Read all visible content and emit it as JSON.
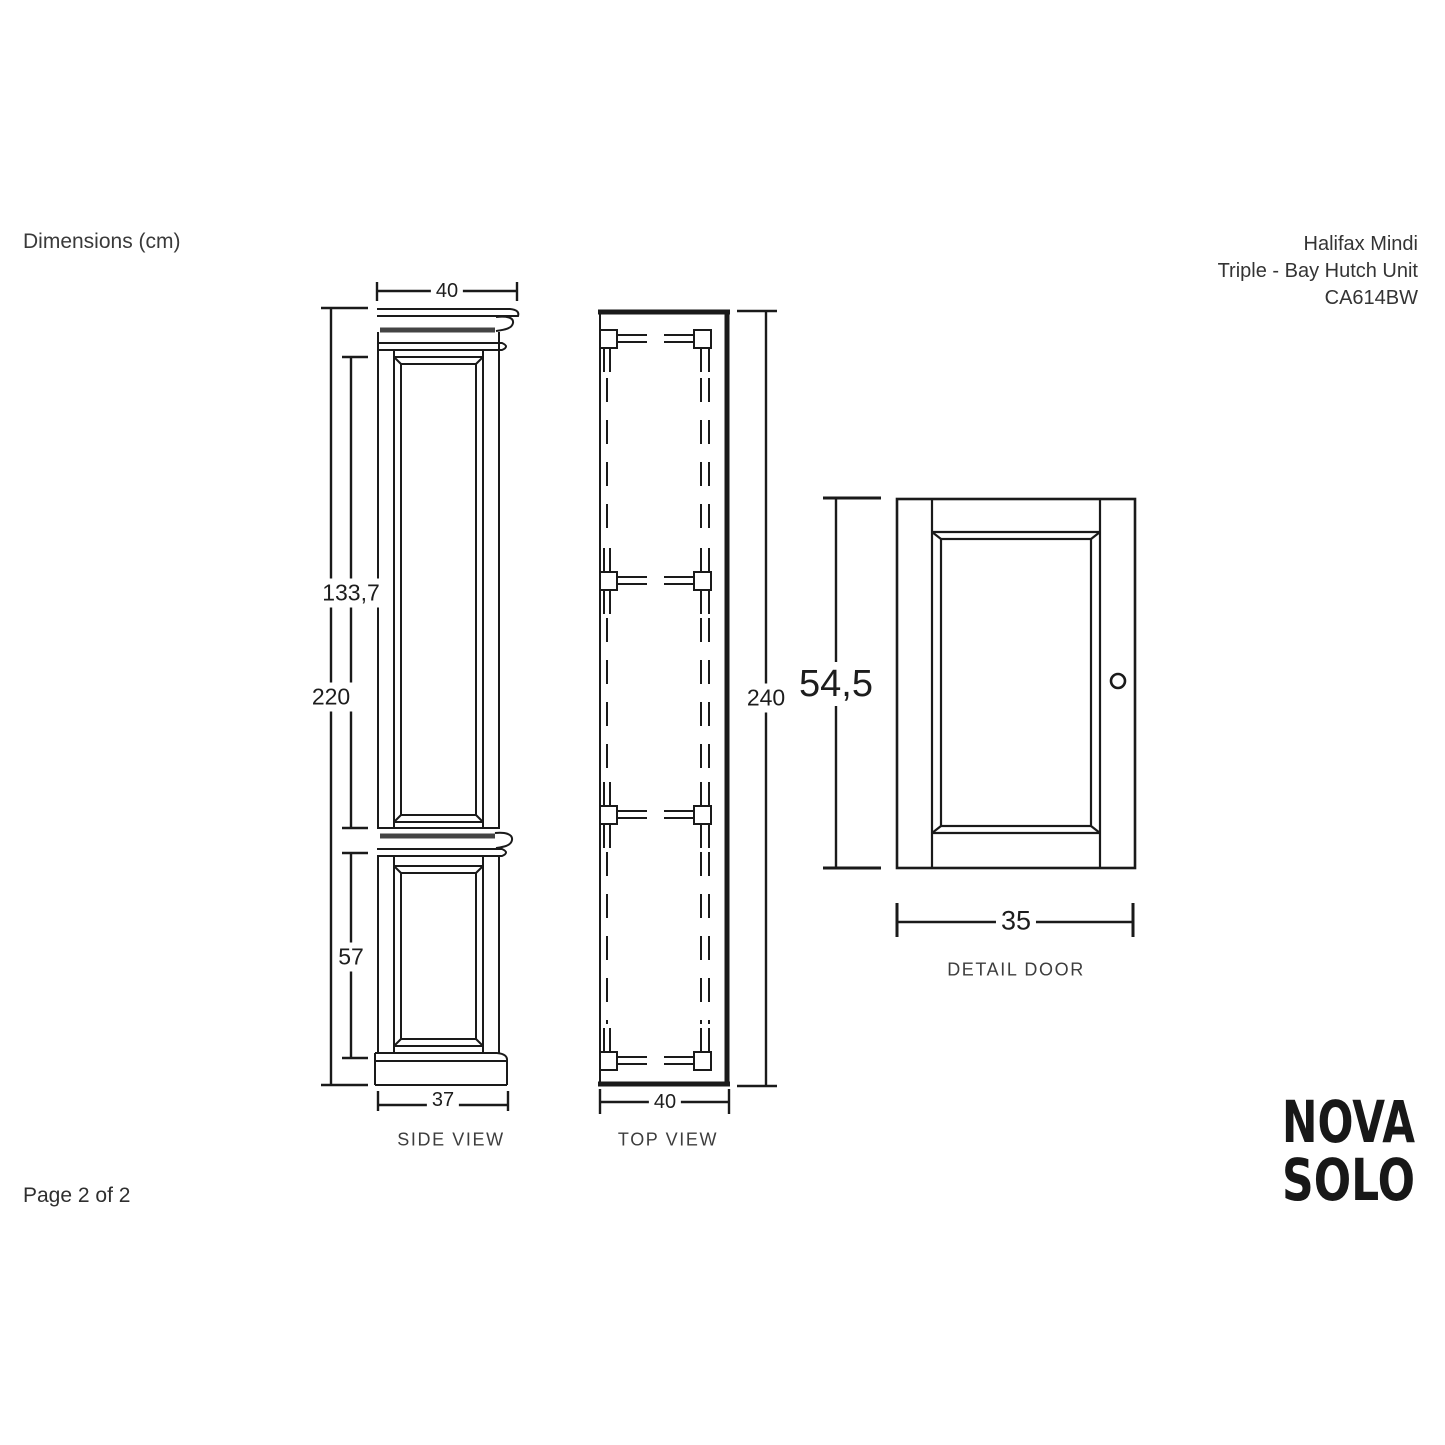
{
  "header": {
    "dimensions_label": "Dimensions (cm)",
    "product": {
      "line1": "Halifax Mindi",
      "line2": "Triple - Bay Hutch Unit",
      "code": "CA614BW"
    }
  },
  "drawing": {
    "units": "cm",
    "side_view": {
      "label": "SIDE VIEW",
      "dim_top_width": "40",
      "dim_upper_section_height": "133,7",
      "dim_total_height": "220",
      "dim_lower_section_height": "57",
      "dim_bottom_width": "37"
    },
    "top_view": {
      "label": "TOP VIEW",
      "dim_height": "240",
      "dim_width": "40"
    },
    "door_detail": {
      "label": "DETAIL DOOR",
      "dim_height": "54,5",
      "dim_width": "35"
    }
  },
  "footer": {
    "page_label": "Page 2 of 2",
    "logo": {
      "line1": "NOVA",
      "line2": "SOLO"
    }
  },
  "colors": {
    "line": "#1a1a1a",
    "molding_band": "#444444",
    "text": "#333333"
  }
}
